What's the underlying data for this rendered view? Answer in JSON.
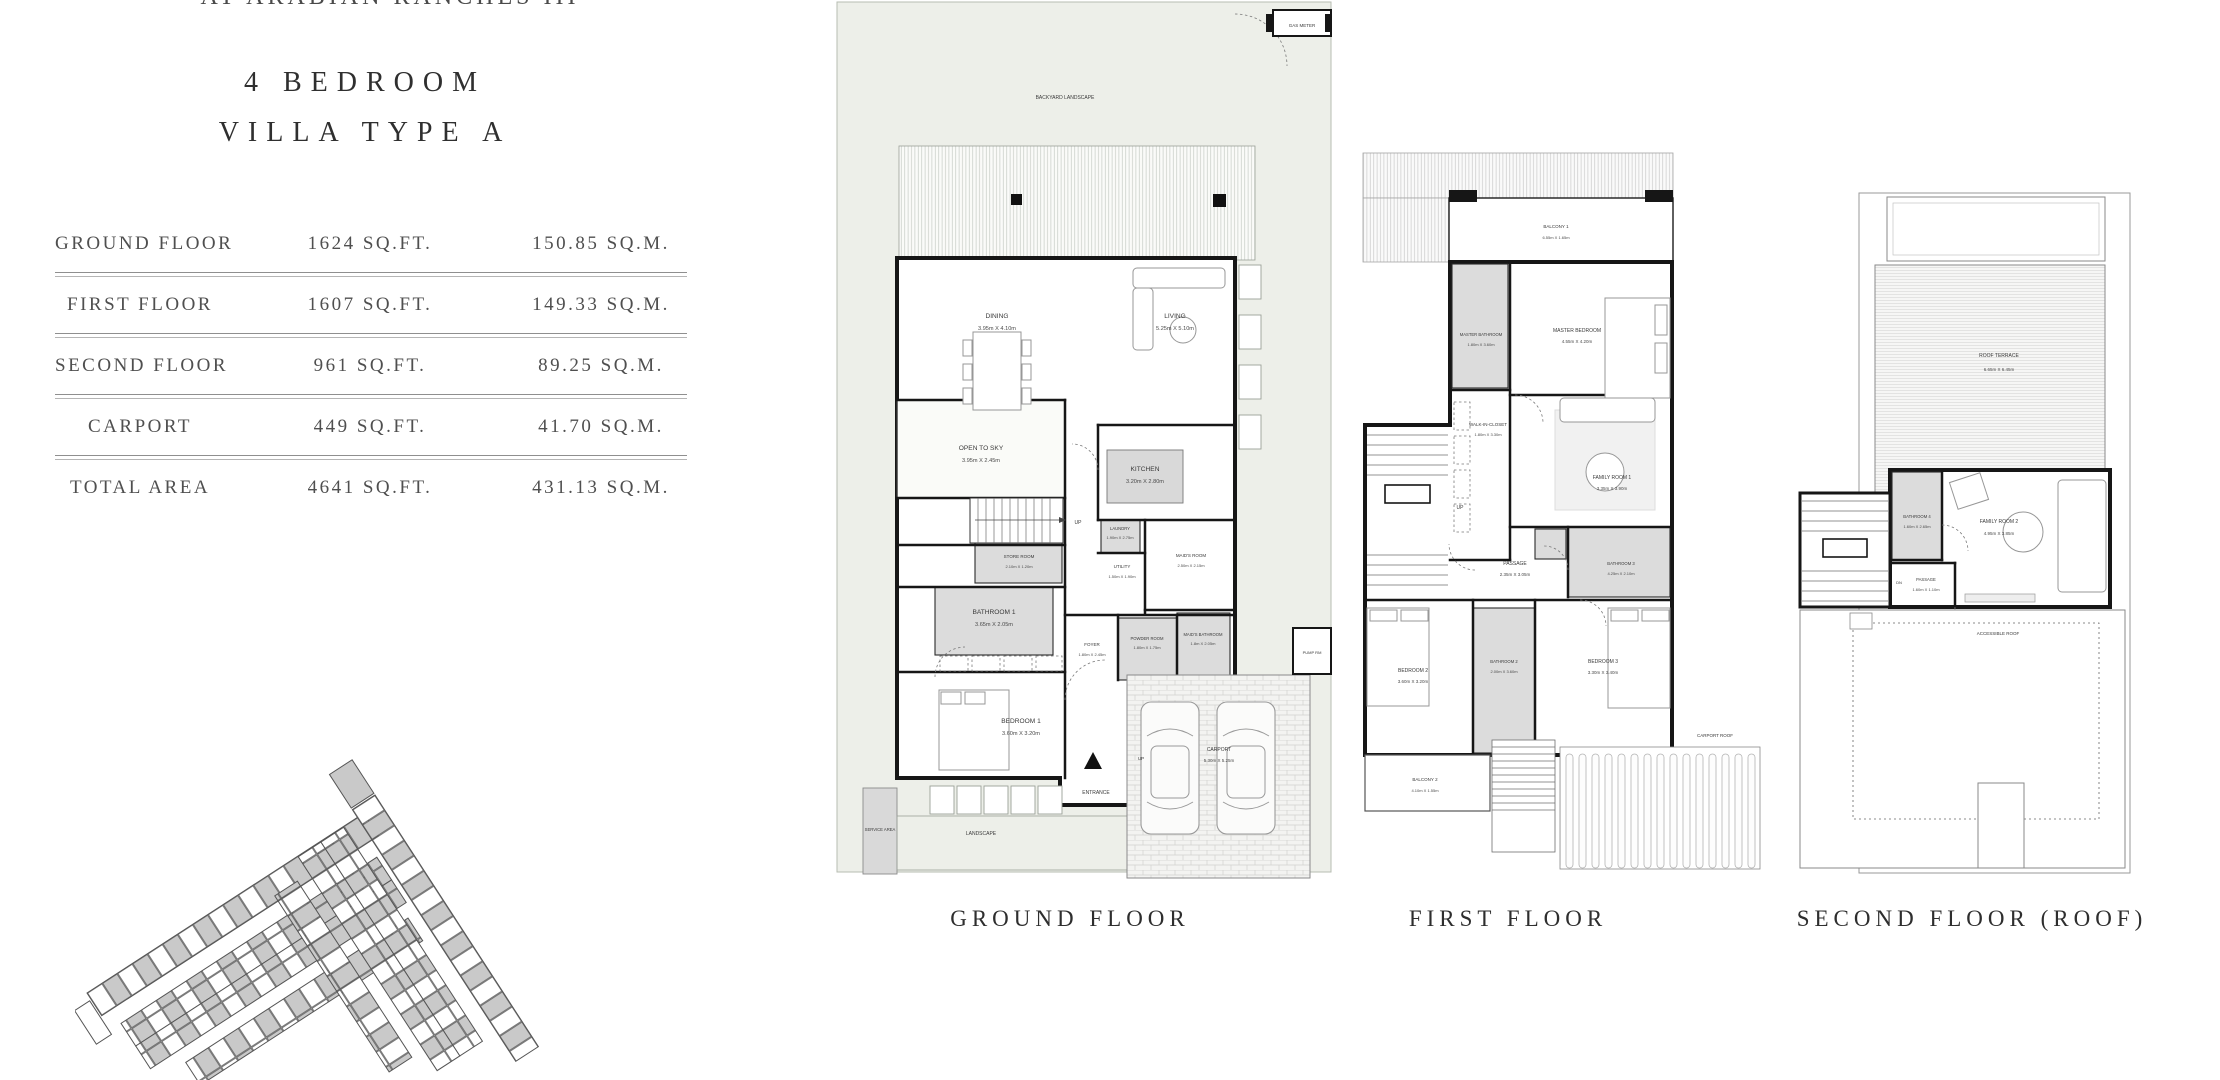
{
  "header": {
    "development": "AT ARABIAN RANCHES III",
    "title_line1": "4 BEDROOM",
    "title_line2": "VILLA TYPE A"
  },
  "area_table": {
    "rows": [
      {
        "label": "GROUND FLOOR",
        "sqft": "1624 SQ.FT.",
        "sqm": "150.85 SQ.M."
      },
      {
        "label": "FIRST FLOOR",
        "sqft": "1607 SQ.FT.",
        "sqm": "149.33 SQ.M."
      },
      {
        "label": "SECOND FLOOR",
        "sqft": "961 SQ.FT.",
        "sqm": "89.25 SQ.M."
      },
      {
        "label": "CARPORT",
        "sqft": "449 SQ.FT.",
        "sqm": "41.70 SQ.M."
      },
      {
        "label": "TOTAL AREA",
        "sqft": "4641 SQ.FT.",
        "sqm": "431.13 SQ.M."
      }
    ]
  },
  "captions": {
    "ground": "GROUND FLOOR",
    "first": "FIRST FLOOR",
    "second": "SECOND FLOOR (ROOF)"
  },
  "ground": {
    "backyard": "BACKYARD LANDSCAPE",
    "gas_meter": "GAS METER",
    "up": "UP",
    "entrance": "ENTRANCE",
    "pump_room": "PUMP RM",
    "service_area": "SERVICE AREA",
    "landscape": "LANDSCAPE",
    "rooms": {
      "dining": {
        "name": "DINING",
        "dims": "3.95m X 4.10m"
      },
      "living": {
        "name": "LIVING",
        "dims": "5.25m X 5.10m"
      },
      "open_to_sky": {
        "name": "OPEN TO SKY",
        "dims": "3.95m X 2.45m"
      },
      "kitchen": {
        "name": "KITCHEN",
        "dims": "3.20m X 2.80m"
      },
      "laundry": {
        "name": "LAUNDRY",
        "dims": "1.90m X 2.75m"
      },
      "utility": {
        "name": "UTILITY",
        "dims": "1.50m X 1.90m"
      },
      "maids_room": {
        "name": "MAID'S ROOM",
        "dims": "2.50m X 2.15m"
      },
      "maids_bathroom": {
        "name": "MAID'S BATHROOM",
        "dims": "1.8m X 2.05m"
      },
      "store_room": {
        "name": "STORE ROOM",
        "dims": "2.10m X 1.20m"
      },
      "bathroom1": {
        "name": "BATHROOM 1",
        "dims": "3.65m X 2.05m"
      },
      "bedroom1": {
        "name": "BEDROOM 1",
        "dims": "3.60m X 3.20m"
      },
      "foyer": {
        "name": "FOYER",
        "dims": "1.80m X 2.45m"
      },
      "powder_room": {
        "name": "POWDER ROOM",
        "dims": "1.80m X 1.75m"
      },
      "carport": {
        "name": "CARPORT",
        "dims": "5.30m X 5.25m"
      }
    }
  },
  "first": {
    "up": "UP",
    "carport_roof": "CARPORT ROOF",
    "rooms": {
      "balcony1": {
        "name": "BALCONY 1",
        "dims": "6.55m X 1.65m"
      },
      "master_bathroom": {
        "name": "MASTER BATHROOM",
        "dims": "1.80m X 3.60m"
      },
      "master_bedroom": {
        "name": "MASTER BEDROOM",
        "dims": "4.55m X 4.20m"
      },
      "walk_in_closet": {
        "name": "WALK-IN-CLOSET",
        "dims": "1.80m X 3.30m"
      },
      "family_room1": {
        "name": "FAMILY ROOM 1",
        "dims": "3.35m X 3.90m"
      },
      "passage": {
        "name": "PASSAGE",
        "dims": "2.35m X 3.05m"
      },
      "bathroom3": {
        "name": "BATHROOM 3",
        "dims": "4.25m X 2.10m"
      },
      "bedroom2": {
        "name": "BEDROOM 2",
        "dims": "3.60m X 3.20m"
      },
      "bathroom2": {
        "name": "BATHROOM 2",
        "dims": "2.00m X 3.60m"
      },
      "bedroom3": {
        "name": "BEDROOM 3",
        "dims": "3.30m X 3.40m"
      },
      "balcony2": {
        "name": "BALCONY 2",
        "dims": "4.10m X 1.55m"
      }
    }
  },
  "second": {
    "dn": "DN",
    "accessible_roof": "ACCESSIBLE ROOF",
    "rooms": {
      "roof_terrace": {
        "name": "ROOF TERRACE",
        "dims": "6.65m X 6.45m"
      },
      "bathroom4": {
        "name": "BATHROOM 4",
        "dims": "1.60m X 2.65m"
      },
      "family_room2": {
        "name": "FAMILY ROOM 2",
        "dims": "4.95m X 3.85m"
      },
      "passage": {
        "name": "PASSAGE",
        "dims": "1.60m X 1.10m"
      }
    }
  },
  "colors": {
    "wall": "#161616",
    "room_shade": "#dcdcdc",
    "landscape": "#edefe9",
    "divider": "#8f8f8f",
    "text": "#3d3d3d"
  }
}
